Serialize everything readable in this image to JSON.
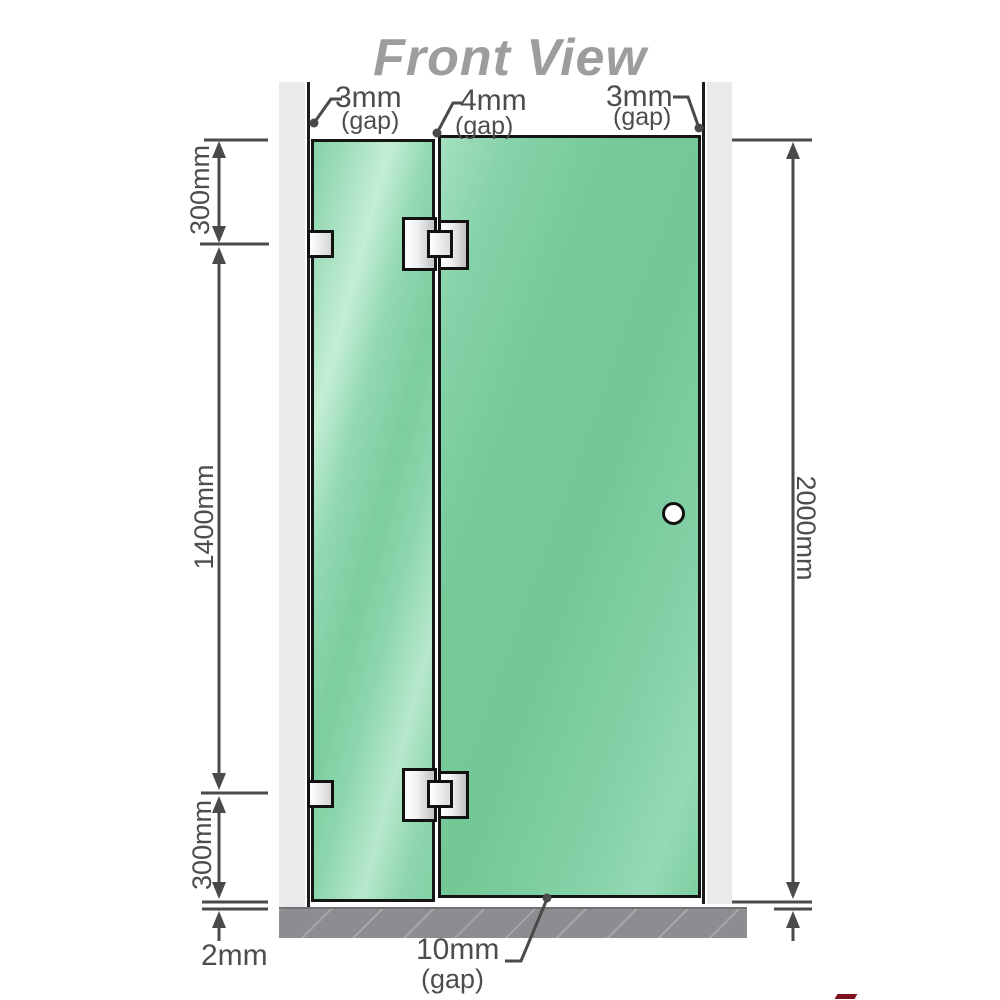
{
  "title": "Front View",
  "view": {
    "dimensions": {
      "left_top": "300mm",
      "left_middle": "1400mm",
      "left_bottom": "300mm",
      "right_height": "2000mm",
      "bottom_left": "2mm"
    },
    "gaps": {
      "top_left": {
        "value": "3mm",
        "label": "(gap)"
      },
      "top_middle": {
        "value": "4mm",
        "label": "(gap)"
      },
      "top_right": {
        "value": "3mm",
        "label": "(gap)"
      },
      "bottom": {
        "value": "10mm",
        "label": "(gap)"
      }
    }
  },
  "parts": {
    "left_wall": "wall",
    "right_wall": "wall",
    "fixed_panel": "fixed-glass-panel",
    "door_panel": "glass-door-panel",
    "hinge_top": "glass-to-glass-hinge",
    "hinge_bottom": "glass-to-glass-hinge",
    "bracket_top": "wall-bracket",
    "bracket_bottom": "wall-bracket",
    "knob": "door-knob",
    "floor": "floor-base"
  },
  "colors": {
    "glass_base": "#7ccd9f",
    "glass_light": "#c4eed6",
    "glass_deep": "#74c897",
    "wall": "#eaeaea",
    "wall_edge": "#1c1c1c",
    "glass_border": "#151515",
    "floor": "#8b8d90",
    "floor_hatch": "#a5a7aa",
    "dim_line": "#4a4a4a",
    "text": "#4d4d4d",
    "title": "#9d9d9d",
    "hardware_border": "#111111",
    "accent_red": "#7e1220"
  }
}
